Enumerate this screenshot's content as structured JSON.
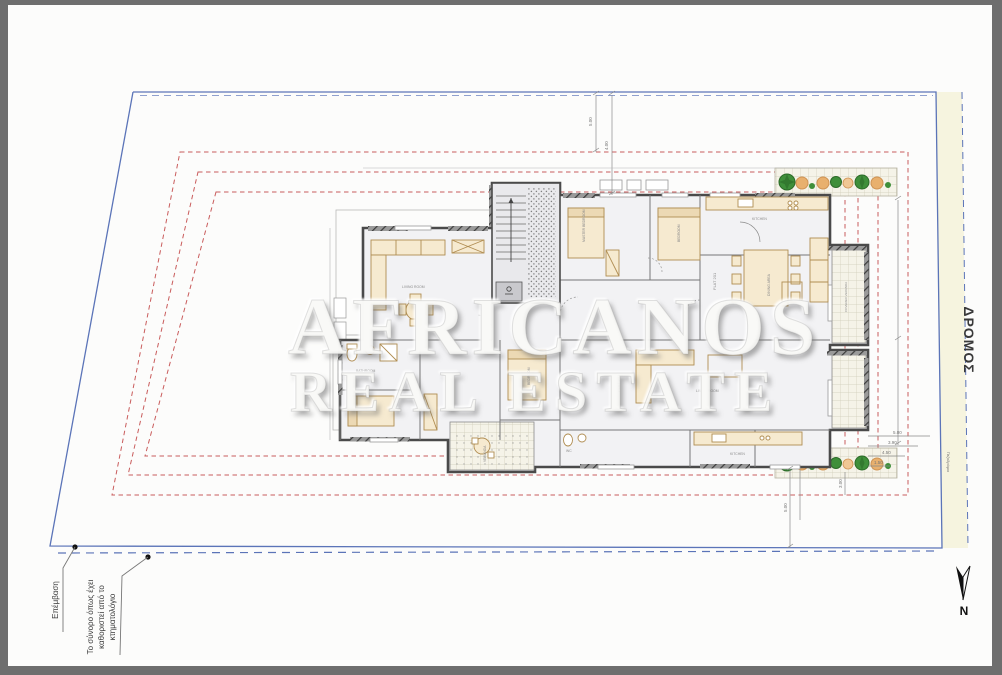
{
  "page": {
    "title": "Architectural site / floor plan drawing",
    "description": "Ground floor plan of an apartment building inside a plot, with blue plot boundary, red dashed setback lines, planting strips with trees, road strip on the right and Greek annotations"
  },
  "watermark": {
    "line1": "AFRICANOS",
    "line2": "REAL ESTATE"
  },
  "labels": {
    "road": "ΔΡΟΜΟΣ",
    "north": "N",
    "intervention": "Επέμβαση",
    "boundary_note_line1": "Το σύνορο όπως έχει",
    "boundary_note_line2": "καθοριστεί από το",
    "boundary_note_line3": "κτηματολόγιο",
    "sidewalk": "Πεζοδρόμιο"
  },
  "dimensions": {
    "d1": "5.00",
    "d2": "4.00",
    "d3": "5.00",
    "d4": "3.00",
    "d5": "5.00",
    "d6": "3.90",
    "d7": "4.50",
    "d8": "1.50"
  },
  "rooms": {
    "r1": "LIVING ROOM",
    "r2": "MASTER BEDROOM",
    "r3": "BEDROOM",
    "r4": "KITCHEN",
    "r5": "DINING AREA",
    "r6": "FLAT 201",
    "r7": "LIVING ROOM",
    "r8": "FLAT 202",
    "r9": "BEDROOM",
    "r10": "BATHROOM",
    "r11": "VERANDA",
    "r12": "COVERED VERANDA",
    "r13": "WC",
    "r14": "KITCHEN"
  },
  "colors": {
    "frame_gray": "#6e6e6e",
    "paper_white": "#fcfcfb",
    "boundary_blue": "#5b74b8",
    "boundary_dash_blue": "#8fa0cf",
    "setback_red": "#c95c5c",
    "road_fill": "#f6f4df",
    "wall_dark": "#4a4a4a",
    "furniture_tan": "#b08d52",
    "furniture_fill": "#f6ead0",
    "tree_green": "#3f8f3a",
    "tree_orange": "#e8b06e",
    "watermark_white": "#f8f8f6"
  }
}
